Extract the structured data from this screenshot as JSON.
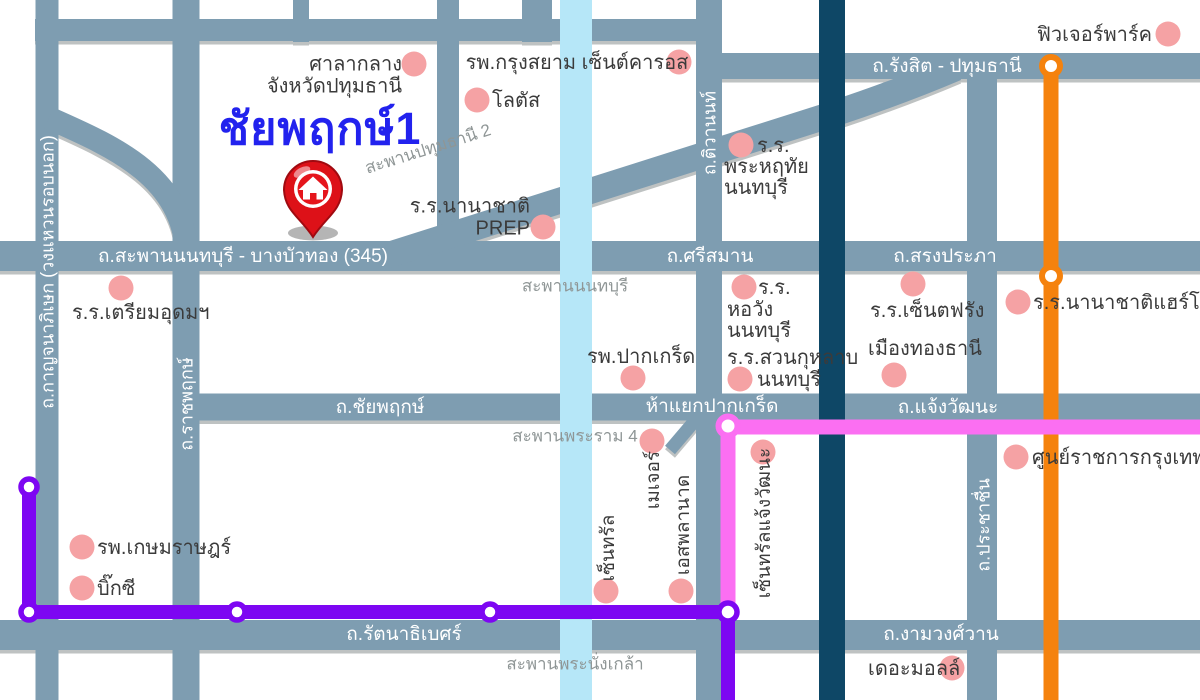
{
  "colors": {
    "road": "#7e9db1",
    "road-shadow": "#b7bbbb",
    "river": "#b6e7f8",
    "canal": "#0e4766",
    "line-orange": "#f5820d",
    "line-purple": "#7d06f2",
    "line-pink": "#fb6ff2",
    "poi-dot": "#f5a2a4",
    "title-blue": "#2222ee",
    "label-dark": "#3b3b3b",
    "label-gray": "#8f9696",
    "road-text": "#ffffff",
    "pin-red": "#dd1118"
  },
  "title": "ชัยพฤกษ์1",
  "roads": {
    "rangsit_pathumthani": "ถ.รังสิต - ปทุมธานี",
    "saphan_nonthaburi_bangbuathong": "ถ.สะพานนนทบุรี - บางบัวทอง (345)",
    "si_saman": "ถ.ศรีสมาน",
    "song_prapha": "ถ.สรงประภา",
    "chaiyaphruek": "ถ.ชัยพฤกษ์",
    "ha_yaek_pak_kret": "ห้าแยกปากเกร็ด",
    "chaengwatthana": "ถ.แจ้งวัฒนะ",
    "rattanathibet": "ถ.รัตนาธิเบศร์",
    "ngamwongwan": "ถ.งามวงศ์วาน",
    "kanchanaphisek": "ถ.กาญจนาภิเษก (วงแหวนรอบนอก)",
    "ratchaphruek": "ถ.ราชพฤกษ์",
    "tiwanon": "ถ.ติวานนท์",
    "prachachuen": "ถ.ประชาชื่น"
  },
  "bridges": {
    "pathumthani2": "สะพานปทุมธานี 2",
    "nonthaburi": "สะพานนนทบุรี",
    "rama4": "สะพานพระราม 4",
    "phranangklao": "สะพานพระนั่งเกล้า"
  },
  "places": {
    "city_hall_line1": "ศาลากลาง",
    "city_hall_line2": "จังหวัดปทุมธานี",
    "krungsiam_hospital": "รพ.กรุงสยาม เซ็นต์คารอส",
    "lotus": "โลตัส",
    "prep_line1": "ร.ร.นานาชาติ",
    "prep_line2": "PREP",
    "future_park": "ฟิวเจอร์พาร์ค",
    "phraharuthai_line1": "ร.ร.",
    "phraharuthai_line2": "พระหฤทัย",
    "phraharuthai_line3": "นนทบุรี",
    "triam_udom": "ร.ร.เตรียมอุดมฯ",
    "pakkret_hospital": "รพ.ปากเกร็ด",
    "horwang_line1": "ร.ร.",
    "horwang_line2": "หอวัง",
    "horwang_line3": "นนทบุรี",
    "suankularb_line1": "ร.ร.สวนกุหลาบ",
    "suankularb_line2": "นนทบุรี",
    "saint_francois": "ร.ร.เซ็นตฟรัง",
    "muang_thong_thani": "เมืองทองธานี",
    "harrow": "ร.ร.นานาชาติแฮร์โรว์",
    "government_complex": "ศูนย์ราชการกรุงเทพฯ",
    "kasemrad_hospital": "รพ.เกษมราษฎร์",
    "big_c": "บิ๊กซี",
    "major": "เมเจอร์",
    "esplanade": "เอสพลานาด",
    "central": "เซ็นทรัล",
    "central_chaengwatthana": "เซ็นทรัลแจ้งวัฒนะ",
    "the_mall": "เดอะมอลล์"
  }
}
